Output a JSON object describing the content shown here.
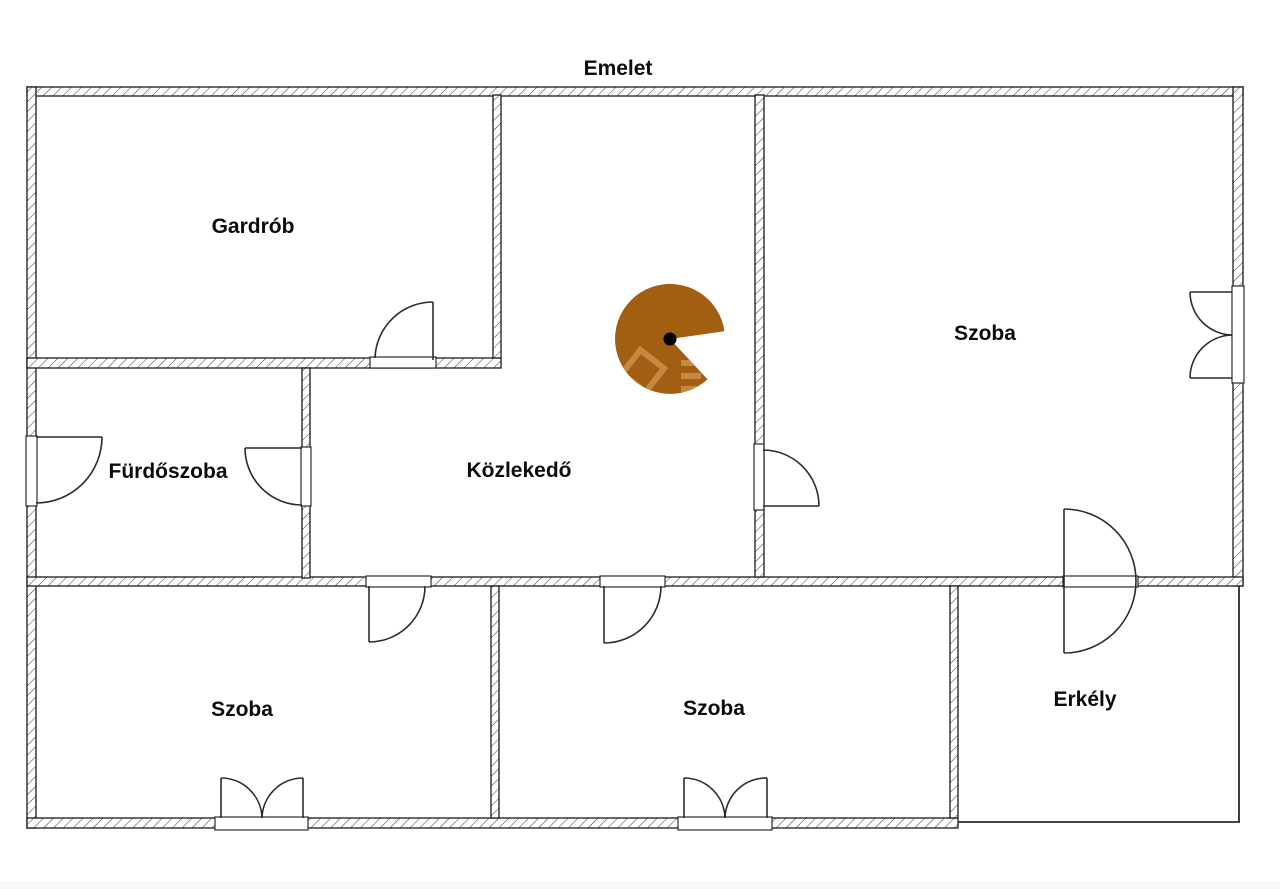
{
  "title": "Emelet",
  "floor_plan": {
    "rooms": [
      {
        "id": "gardrob",
        "label": "Gardrób"
      },
      {
        "id": "szoba-top",
        "label": "Szoba"
      },
      {
        "id": "furdoszoba",
        "label": "Fürdőszoba"
      },
      {
        "id": "kozlekedo",
        "label": "Közlekedő"
      },
      {
        "id": "szoba-bottom-left",
        "label": "Szoba"
      },
      {
        "id": "szoba-bottom-center",
        "label": "Szoba"
      },
      {
        "id": "erkely",
        "label": "Erkély"
      }
    ],
    "camera_marker": {
      "color": "#a25e11",
      "dot_color": "#000000",
      "watermark_tint": "#cf9a55"
    },
    "colors": {
      "wall_line": "#1a1a1a",
      "hatch_line": "#3a3a3a",
      "door_line": "#2b2b2b",
      "background": "#ffffff",
      "bottom_strip": "#f8f8f8"
    }
  }
}
